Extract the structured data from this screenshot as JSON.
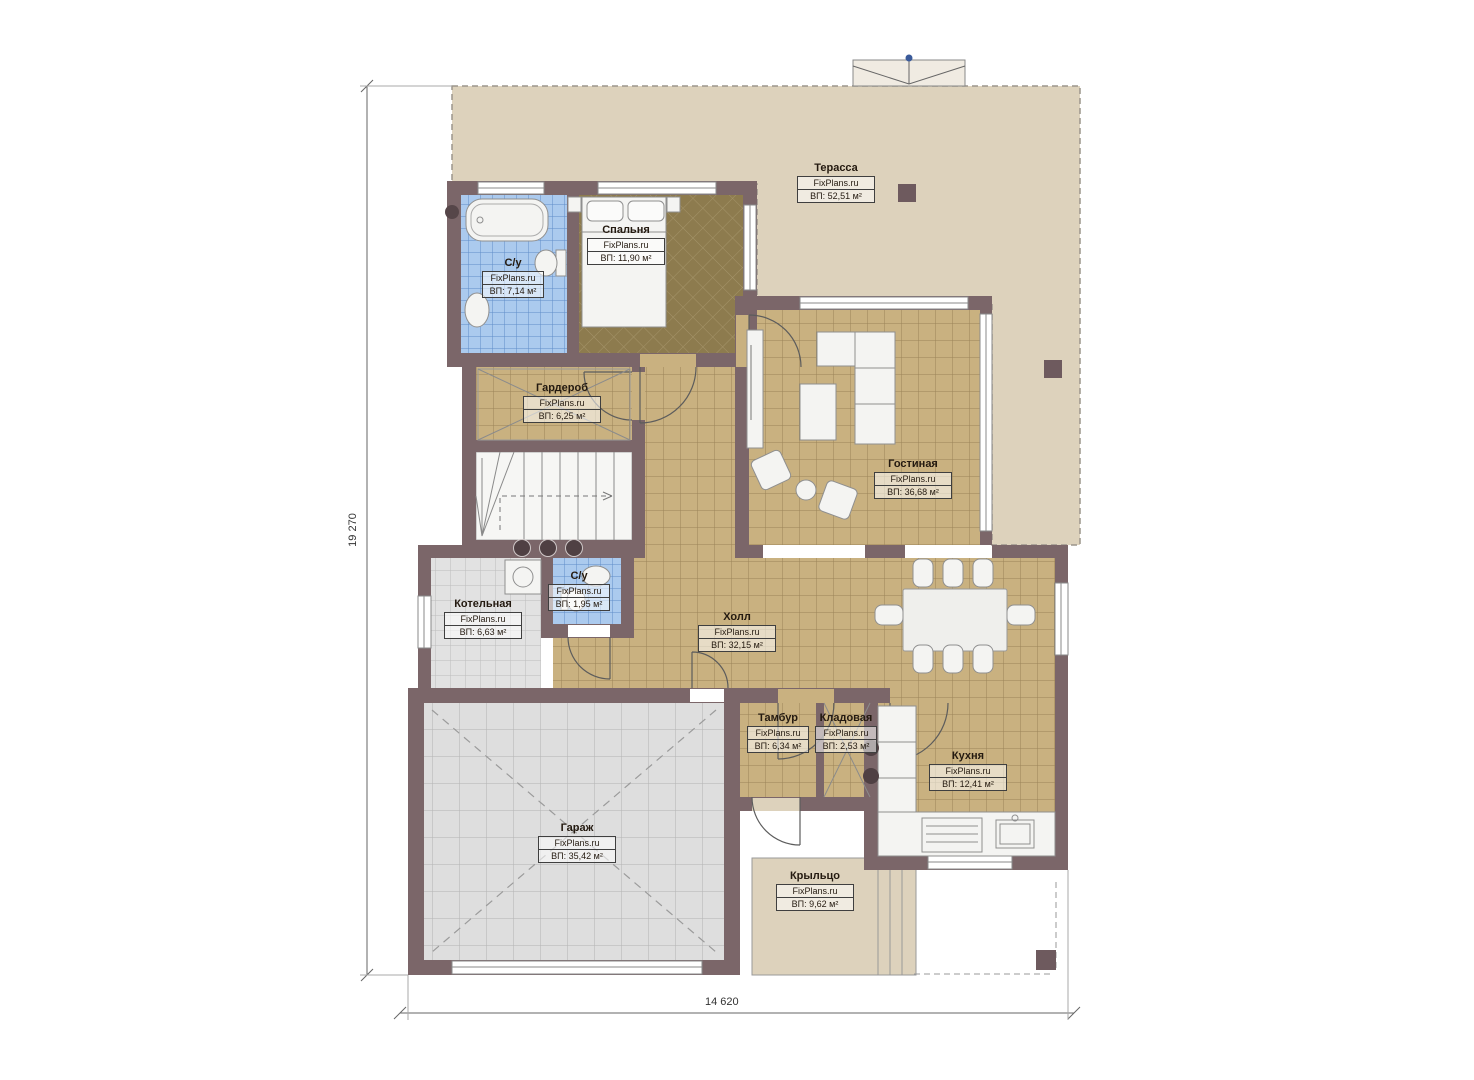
{
  "watermark": "FixPlans.ru",
  "dimensions": {
    "vertical": "19 270",
    "horizontal": "14 620"
  },
  "rooms": [
    {
      "id": "terrace",
      "name": "Терасса",
      "area": "ВП: 52,51 м²"
    },
    {
      "id": "bedroom",
      "name": "Спальня",
      "area": "ВП: 11,90 м²"
    },
    {
      "id": "bathroom-main",
      "name": "С/у",
      "area": "ВП: 7,14 м²"
    },
    {
      "id": "wardrobe",
      "name": "Гардероб",
      "area": "ВП: 6,25 м²"
    },
    {
      "id": "living-room",
      "name": "Гостиная",
      "area": "ВП: 36,68 м²"
    },
    {
      "id": "boiler-room",
      "name": "Котельная",
      "area": "ВП: 6,63 м²"
    },
    {
      "id": "bathroom-small",
      "name": "С/у",
      "area": "ВП: 1,95 м²"
    },
    {
      "id": "hall",
      "name": "Холл",
      "area": "ВП: 32,15 м²"
    },
    {
      "id": "vestibule",
      "name": "Тамбур",
      "area": "ВП: 6,34 м²"
    },
    {
      "id": "pantry",
      "name": "Кладовая",
      "area": "ВП: 2,53 м²"
    },
    {
      "id": "kitchen",
      "name": "Кухня",
      "area": "ВП: 12,41 м²"
    },
    {
      "id": "garage",
      "name": "Гараж",
      "area": "ВП: 35,42 м²"
    },
    {
      "id": "porch",
      "name": "Крыльцо",
      "area": "ВП: 9,62 м²"
    }
  ],
  "colors": {
    "wall": "#7b6669",
    "terrace": "#ddd2bc",
    "tile_tan": "#c9b180",
    "tile_blue": "#abcaee",
    "tile_gray": "#e2e2e2",
    "bedroom_floor": "#8d7b4e"
  }
}
